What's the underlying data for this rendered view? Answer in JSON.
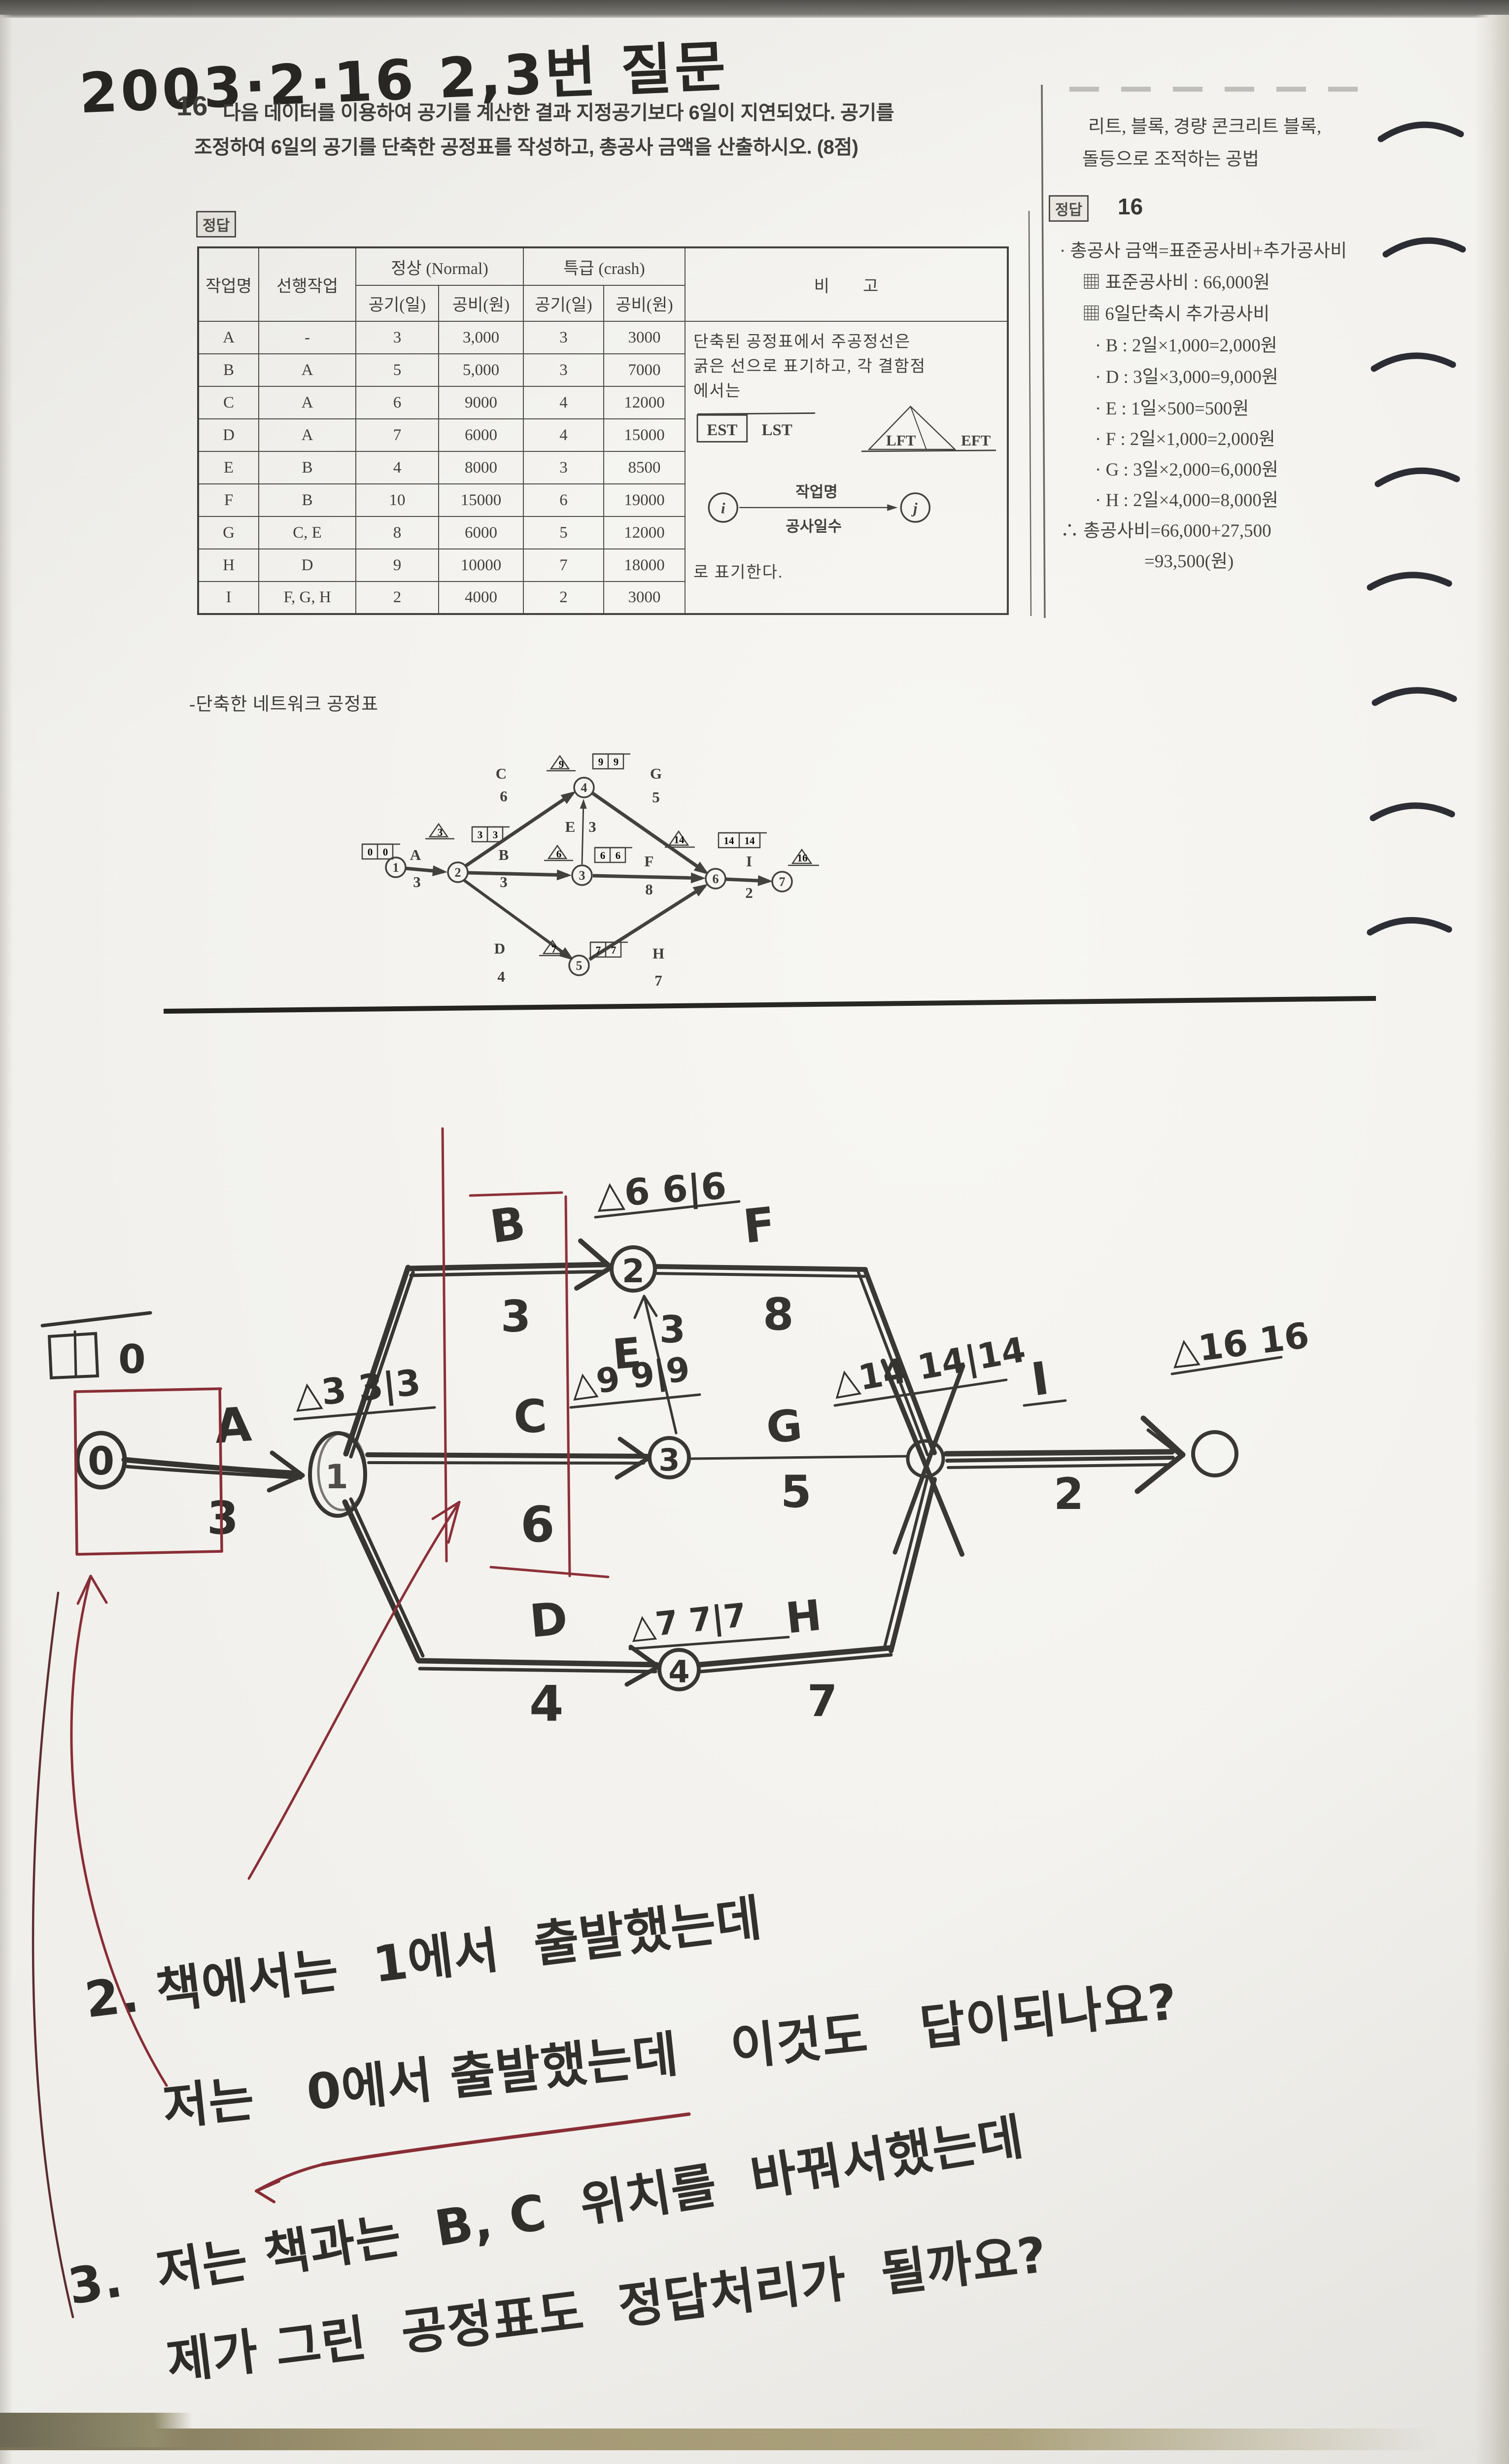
{
  "photo": {
    "date_note": "2003·2·16   2,3번 질문"
  },
  "problem": {
    "number": "16",
    "line1": "다음 데이터를 이용하여 공기를 계산한 결과 지정공기보다 6일이 지연되었다. 공기를",
    "line2": "조정하여 6일의 공기를 단축한 공정표를 작성하고, 총공사 금액을 산출하시오. (8점)",
    "answer_tag": "정답"
  },
  "table": {
    "headers": {
      "task": "작업명",
      "pred": "선행작업",
      "normal": "정상 (Normal)",
      "crash": "특급 (crash)",
      "days": "공기(일)",
      "cost": "공비(원)",
      "note": "비        고"
    },
    "rows": [
      {
        "task": "A",
        "pred": "-",
        "n_days": "3",
        "n_cost": "3,000",
        "c_days": "3",
        "c_cost": "3000"
      },
      {
        "task": "B",
        "pred": "A",
        "n_days": "5",
        "n_cost": "5,000",
        "c_days": "3",
        "c_cost": "7000"
      },
      {
        "task": "C",
        "pred": "A",
        "n_days": "6",
        "n_cost": "9000",
        "c_days": "4",
        "c_cost": "12000"
      },
      {
        "task": "D",
        "pred": "A",
        "n_days": "7",
        "n_cost": "6000",
        "c_days": "4",
        "c_cost": "15000"
      },
      {
        "task": "E",
        "pred": "B",
        "n_days": "4",
        "n_cost": "8000",
        "c_days": "3",
        "c_cost": "8500"
      },
      {
        "task": "F",
        "pred": "B",
        "n_days": "10",
        "n_cost": "15000",
        "c_days": "6",
        "c_cost": "19000"
      },
      {
        "task": "G",
        "pred": "C, E",
        "n_days": "8",
        "n_cost": "6000",
        "c_days": "5",
        "c_cost": "12000"
      },
      {
        "task": "H",
        "pred": "D",
        "n_days": "9",
        "n_cost": "10000",
        "c_days": "7",
        "c_cost": "18000"
      },
      {
        "task": "I",
        "pred": "F, G, H",
        "n_days": "2",
        "n_cost": "4000",
        "c_days": "2",
        "c_cost": "3000"
      }
    ],
    "note": {
      "line1": "단축된 공정표에서 주공정선은",
      "line2": "굵은 선으로 표기하고, 각 결함점",
      "line3": "에서는",
      "est": "EST",
      "lst": "LST",
      "lft": "LFT",
      "eft": "EFT",
      "i": "i",
      "j": "j",
      "arrow_top": "작업명",
      "arrow_bottom": "공사일수",
      "footer": "로 표기한다."
    }
  },
  "network_title": "-단축한 네트워크 공정표",
  "printed_diagram": {
    "nodes": [
      "1",
      "2",
      "3",
      "4",
      "5",
      "6",
      "7"
    ],
    "edges": [
      {
        "name": "A",
        "dur": "3"
      },
      {
        "name": "B",
        "dur": "3"
      },
      {
        "name": "C",
        "dur": "6"
      },
      {
        "name": "D",
        "dur": "4"
      },
      {
        "name": "E",
        "dur": "3"
      },
      {
        "name": "F",
        "dur": "8"
      },
      {
        "name": "G",
        "dur": "5"
      },
      {
        "name": "H",
        "dur": "7"
      },
      {
        "name": "I",
        "dur": "2"
      }
    ],
    "tri": {
      "n2": "3",
      "n3": "6",
      "n4": "9",
      "n5": "7",
      "n6": "14",
      "n7": "16"
    },
    "box": {
      "n1": [
        "0",
        "0"
      ],
      "n2": [
        "3",
        "3"
      ],
      "n3": [
        "6",
        "6"
      ],
      "n4": [
        "9",
        "9"
      ],
      "n5": [
        "7",
        "7"
      ],
      "n6": [
        "14",
        "14"
      ]
    }
  },
  "sidebar": {
    "top_line1": "리트, 블록, 경량 콘크리트 블록,",
    "top_line2": "돌등으로 조적하는 공법",
    "answer_tag": "정답",
    "answer_number": "16",
    "lines": [
      "· 총공사 금액=표준공사비+추가공사비",
      "▦ 표준공사비 : 66,000원",
      "▦ 6일단축시 추가공사비",
      "· B : 2일×1,000=2,000원",
      "· D : 3일×3,000=9,000원",
      "· E : 1일×500=500원",
      "· F : 2일×1,000=2,000원",
      "· G : 3일×2,000=6,000원",
      "· H : 2일×4,000=8,000원",
      "∴ 총공사비=66,000+27,500",
      "=93,500(원)"
    ]
  },
  "hand_diagram": {
    "start_est": "0",
    "nodes": {
      "start": "0",
      "after_a": "1",
      "top": "2",
      "mid": "3",
      "bottom": "4"
    },
    "est_labels": {
      "after_a": "△3 3|3",
      "top": "△6 6|6",
      "mid": "△9 9|9",
      "bottom": "△7 7|7",
      "merge": "△14 14|14",
      "end": "△16 16"
    },
    "edges": [
      {
        "name": "A",
        "dur": "3"
      },
      {
        "name": "B",
        "dur": "3"
      },
      {
        "name": "C",
        "dur": "6"
      },
      {
        "name": "D",
        "dur": "4"
      },
      {
        "name": "E",
        "dur": "3"
      },
      {
        "name": "F",
        "dur": "8"
      },
      {
        "name": "G",
        "dur": "5"
      },
      {
        "name": "H",
        "dur": "7"
      },
      {
        "name": "I",
        "dur": "2"
      }
    ]
  },
  "questions": {
    "q2_line1": "2. 책에서는  1에서  출발했는데",
    "q2_line2": "저는   0에서 출발했는데   이것도   답이되나요?",
    "q3_line1": "3.  저는 책과는  B, C  위치를  바꿔서했는데",
    "q3_line2": "제가 그린  공정표도  정답처리가  될까요?"
  }
}
